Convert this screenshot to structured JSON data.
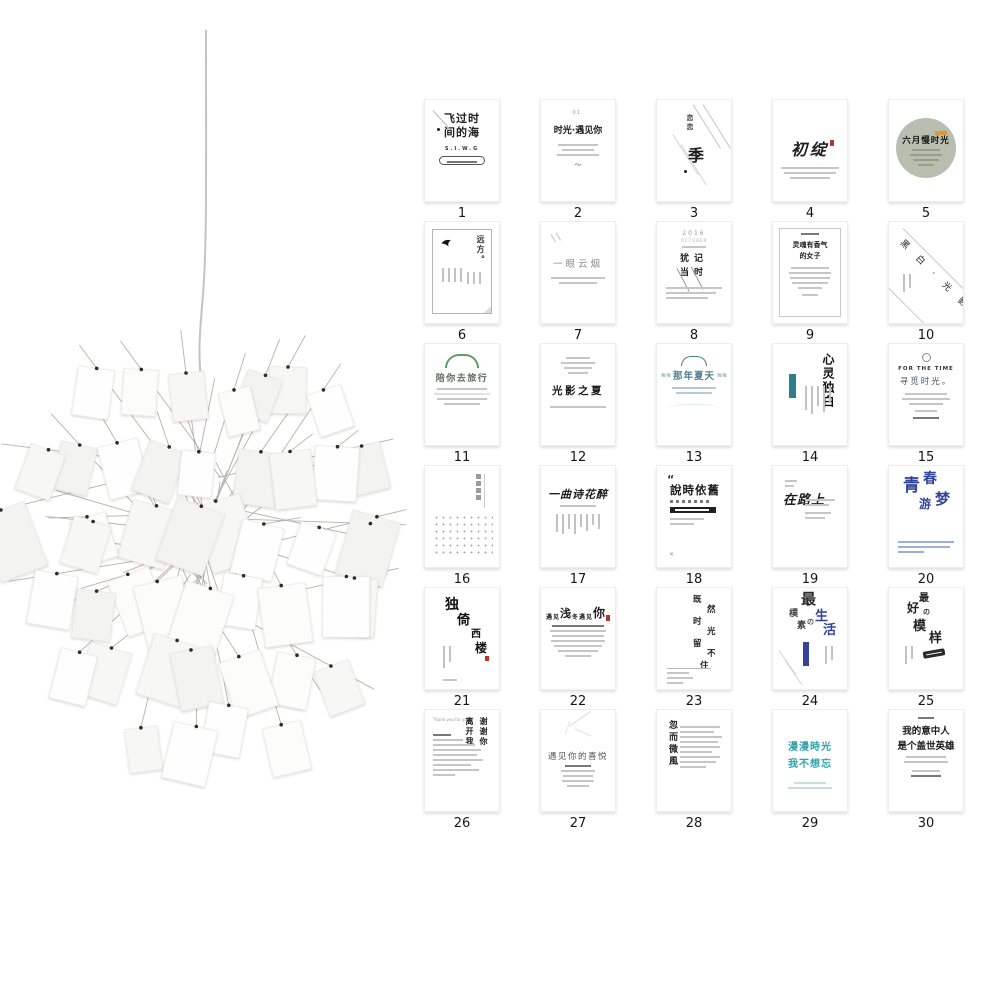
{
  "colors": {
    "ink": "#1d1d1d",
    "gray_text": "#8f8f8f",
    "line": "#c6c6c6",
    "teal": "#4e7d8e",
    "teal_tag": "#2d7f8e",
    "teal_bright": "#2fa3ad",
    "green": "#5f9e63",
    "sage": "#b8bfb1",
    "blue": "#32449b",
    "orange": "#e2992f",
    "seal_red": "#b5342c",
    "background": "#ffffff"
  },
  "cards": [
    {
      "num": "1",
      "style": "s1",
      "title": "飞过时间的海",
      "sub": "S.I.W.G"
    },
    {
      "num": "2",
      "style": "s2",
      "pre": "01.",
      "title": "时光·遇见你"
    },
    {
      "num": "3",
      "style": "s3",
      "small": "恋恋",
      "big": "季"
    },
    {
      "num": "4",
      "style": "s4",
      "title": "初绽"
    },
    {
      "num": "5",
      "style": "s5",
      "title": "六月慢时光"
    },
    {
      "num": "6",
      "style": "s6",
      "title": "远方。"
    },
    {
      "num": "7",
      "style": "s7",
      "title": "一眼云烟"
    },
    {
      "num": "8",
      "style": "s8",
      "pre": "2016",
      "pre2": "OCTOBER",
      "title": "犹记当时"
    },
    {
      "num": "9",
      "style": "s9",
      "title": "灵魂有香气",
      "title2": "的女子"
    },
    {
      "num": "10",
      "style": "s10",
      "title": "黑 白 · 光 影"
    },
    {
      "num": "11",
      "style": "s11",
      "title": "陪你去旅行"
    },
    {
      "num": "12",
      "style": "s12",
      "title": "光影之夏"
    },
    {
      "num": "13",
      "style": "s13",
      "title": "那年夏天"
    },
    {
      "num": "14",
      "style": "s14",
      "title": "心灵独白"
    },
    {
      "num": "15",
      "style": "s15",
      "en": "FOR THE TIME",
      "title": "寻觅时光。"
    },
    {
      "num": "16",
      "style": "s16"
    },
    {
      "num": "17",
      "style": "s17",
      "title": "一曲诗花醉"
    },
    {
      "num": "18",
      "style": "s18",
      "title": "說時依舊"
    },
    {
      "num": "19",
      "style": "s19",
      "title": "在路上"
    },
    {
      "num": "20",
      "style": "s20",
      "title": "青春",
      "title2": "游梦"
    },
    {
      "num": "21",
      "style": "s21",
      "title": "独倚西楼"
    },
    {
      "num": "22",
      "style": "s22",
      "title": "遇见浅冬遇见你"
    },
    {
      "num": "23",
      "style": "s23",
      "title": "既然时光留不住"
    },
    {
      "num": "24",
      "style": "s24",
      "title": "最樸素の生活"
    },
    {
      "num": "25",
      "style": "s25",
      "title": "最好の模样"
    },
    {
      "num": "26",
      "style": "s26",
      "en": "Thank you for your love",
      "col1": "谢谢你",
      "col2": "离开我"
    },
    {
      "num": "27",
      "style": "s27",
      "title": "遇见你的喜悦"
    },
    {
      "num": "28",
      "style": "s28",
      "title": "忽而微風"
    },
    {
      "num": "29",
      "style": "s29",
      "title": "漫漫時光",
      "title2": "我不想忘"
    },
    {
      "num": "30",
      "style": "s30",
      "title": "我的意中人",
      "title2": "是个盖世英雄"
    }
  ]
}
